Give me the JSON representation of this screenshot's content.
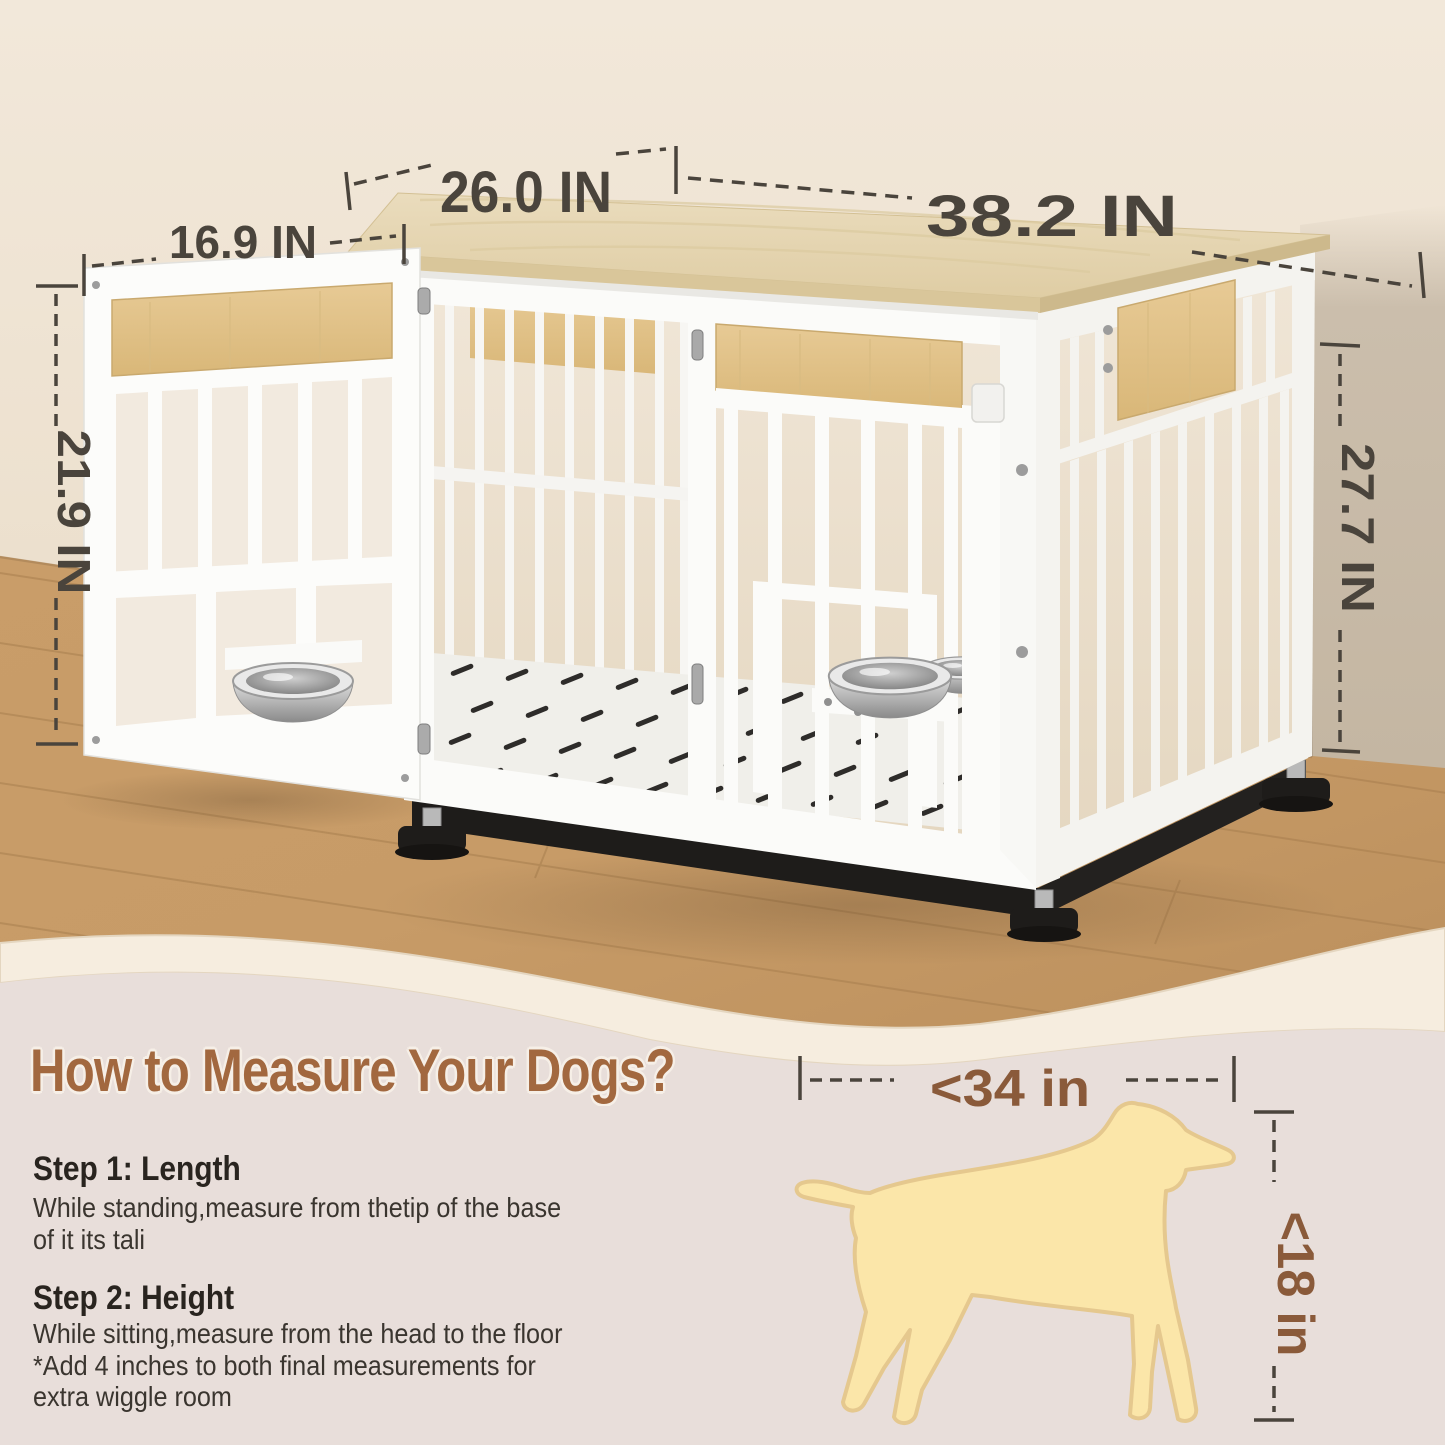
{
  "product": {
    "dimensions": {
      "top_depth": "26.0 IN",
      "top_width": "38.2 IN",
      "door_width": "16.9 IN",
      "door_height": "21.9 IN",
      "crate_height": "27.7 IN"
    }
  },
  "dog_guide": {
    "heading": "How to Measure Your Dogs?",
    "length_limit": "<34 in",
    "height_limit": "<18 in",
    "steps": [
      {
        "title": "Step 1: Length",
        "lines": [
          "While standing,measure from thetip of the base",
          "of it its tali"
        ]
      },
      {
        "title": "Step 2: Height",
        "lines": [
          "While sitting,measure from the head to the floor",
          "*Add 4 inches to both final measurements for",
          "extra wiggle room"
        ]
      }
    ]
  },
  "colors": {
    "wall": "#F0E5D6",
    "wall_shadow": "#CBBEAC",
    "floor": "#C79B67",
    "tabletop_wood": "#E8DABA",
    "accent_wood": "#E2C38C",
    "crate_white": "#FBFBF9",
    "base_black": "#1E1C1A",
    "band_cream": "#F6EDDF",
    "bottom_bg": "#E8DEDA",
    "heading_brown": "#A2683F",
    "dimension_text": "#4A443C",
    "dog_dimension_brown": "#8A5A3A",
    "dog_fill": "#FBE6A9",
    "dog_outline": "#E5C88E"
  }
}
